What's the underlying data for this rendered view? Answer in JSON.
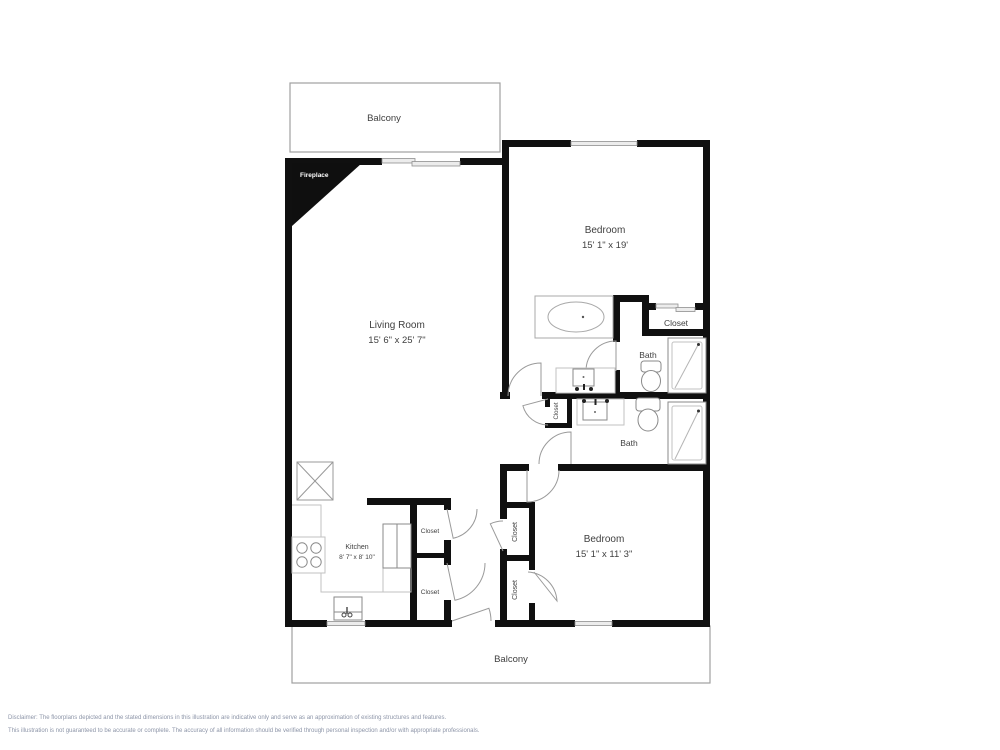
{
  "document": {
    "type": "floor-plan",
    "disclaimer_line1": "Disclaimer: The floorplans depicted and the stated dimensions in this illustration are indicative only and serve as an approximation of existing structures and features.",
    "disclaimer_line2": "This illustration is not guaranteed to be accurate or complete. The accuracy of all information should be verified through personal inspection and/or with appropriate professionals."
  },
  "colors": {
    "wall": "#101010",
    "fixture_outline": "#8a8a8a",
    "counter_outline": "#c2c2c2",
    "window_fill": "#ececec",
    "label_text": "#3f3f3f",
    "disclaimer_text": "#8d95a8"
  },
  "labels": {
    "balcony_top": "Balcony",
    "balcony_bottom": "Balcony",
    "fireplace": "Fireplace",
    "living_room": {
      "name": "Living Room",
      "dims": "15' 6\" x 25' 7\""
    },
    "bedroom_1": {
      "name": "Bedroom",
      "dims": "15' 1\" x 19'"
    },
    "bedroom_2": {
      "name": "Bedroom",
      "dims": "15' 1\" x 11' 3\""
    },
    "kitchen": {
      "name": "Kitchen",
      "dims": "8' 7\" x 8' 10\""
    },
    "bath_master": "Bath",
    "bath_hall": "Bath",
    "closet_master": "Closet",
    "closet_hall_small": "Closet",
    "closet_kitchen_upper": "Closet",
    "closet_kitchen_lower": "Closet",
    "closet_bedroom2_upper": "Closet",
    "closet_bedroom2_lower": "Closet"
  }
}
